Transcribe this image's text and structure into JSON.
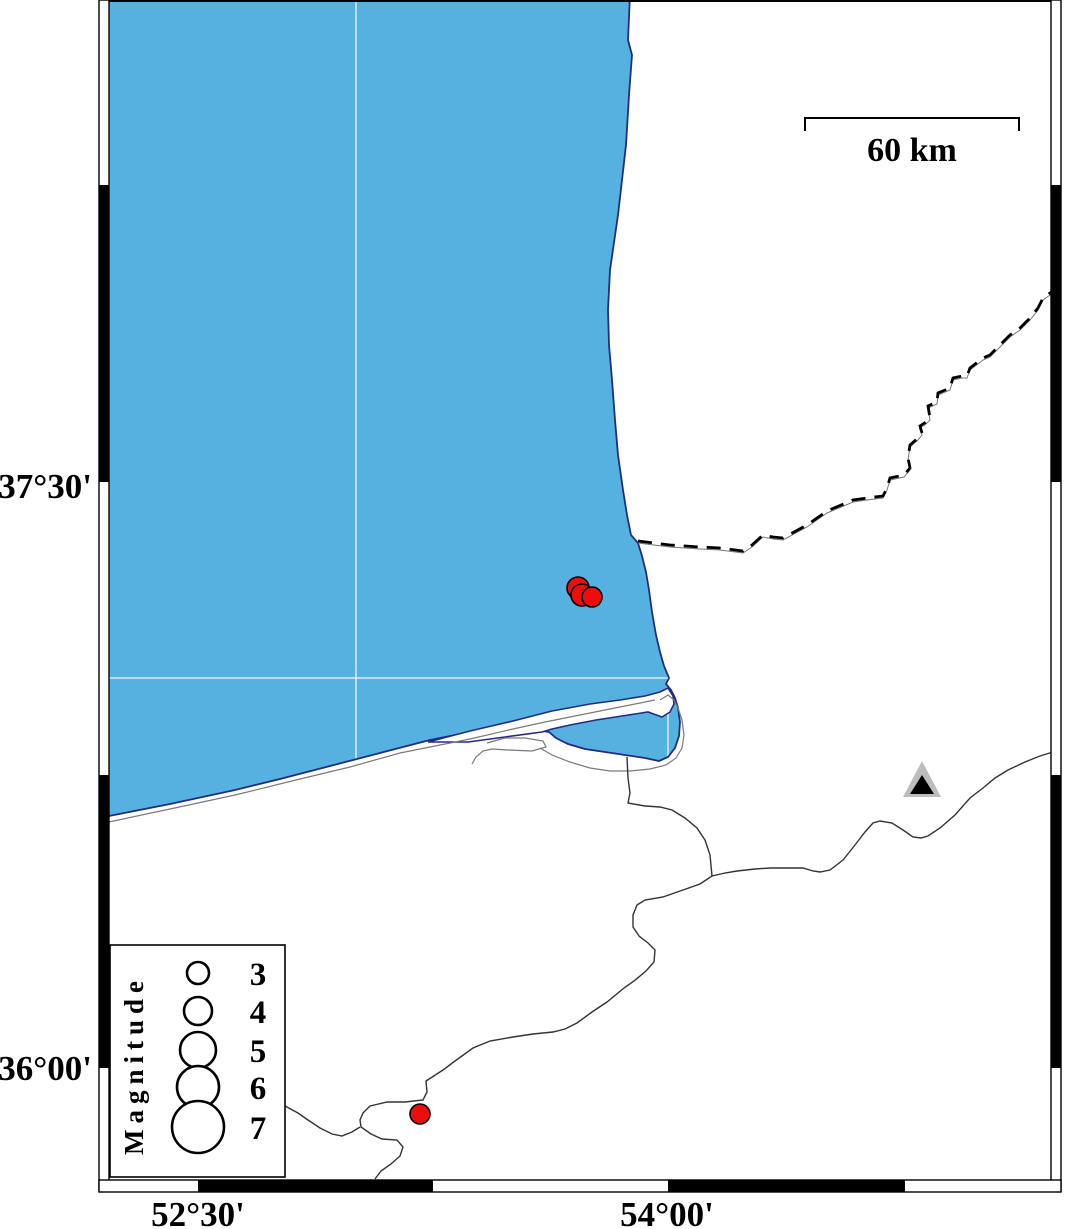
{
  "map": {
    "title": "",
    "axis": {
      "lat_labels": [
        {
          "text": "37°30'",
          "y": 486
        },
        {
          "text": "36°00'",
          "y": 1068
        }
      ],
      "lon_labels": [
        {
          "text": "52°30'",
          "x": 198
        },
        {
          "text": "54°00'",
          "x": 667
        }
      ]
    },
    "gridlines": {
      "vertical_x": [
        356,
        668
      ],
      "horizontal_y": [
        678
      ]
    },
    "scalebar": {
      "label": "60 km",
      "x1": 805,
      "x2": 1019,
      "y": 118,
      "tick_drop": 13
    },
    "legend": {
      "title": "Magnitude",
      "circle_cx": 198,
      "label_x": 258,
      "entries": [
        {
          "magnitude": "3",
          "radius": 11,
          "cy": 973
        },
        {
          "magnitude": "4",
          "radius": 14,
          "cy": 1011
        },
        {
          "magnitude": "5",
          "radius": 18,
          "cy": 1050
        },
        {
          "magnitude": "6",
          "radius": 21,
          "cy": 1087
        },
        {
          "magnitude": "7",
          "radius": 26,
          "cy": 1127
        }
      ]
    },
    "epicenters": [
      {
        "x": 578,
        "y": 588,
        "r": 11
      },
      {
        "x": 582,
        "y": 595,
        "r": 11
      },
      {
        "x": 592,
        "y": 597,
        "r": 10
      },
      {
        "x": 420,
        "y": 1114,
        "r": 10
      }
    ],
    "station": {
      "x": 922,
      "y": 782
    },
    "colors": {
      "sea": "#55B2E0",
      "coast": "#232B85",
      "epicenter": "#EE0C0C",
      "station_outer": "#BDBDBD",
      "station_inner": "#000000",
      "river": "#333333",
      "secondary_shore": "#7a7a7a",
      "border_dash": "#000000",
      "grid": "#FFFFFF"
    }
  }
}
